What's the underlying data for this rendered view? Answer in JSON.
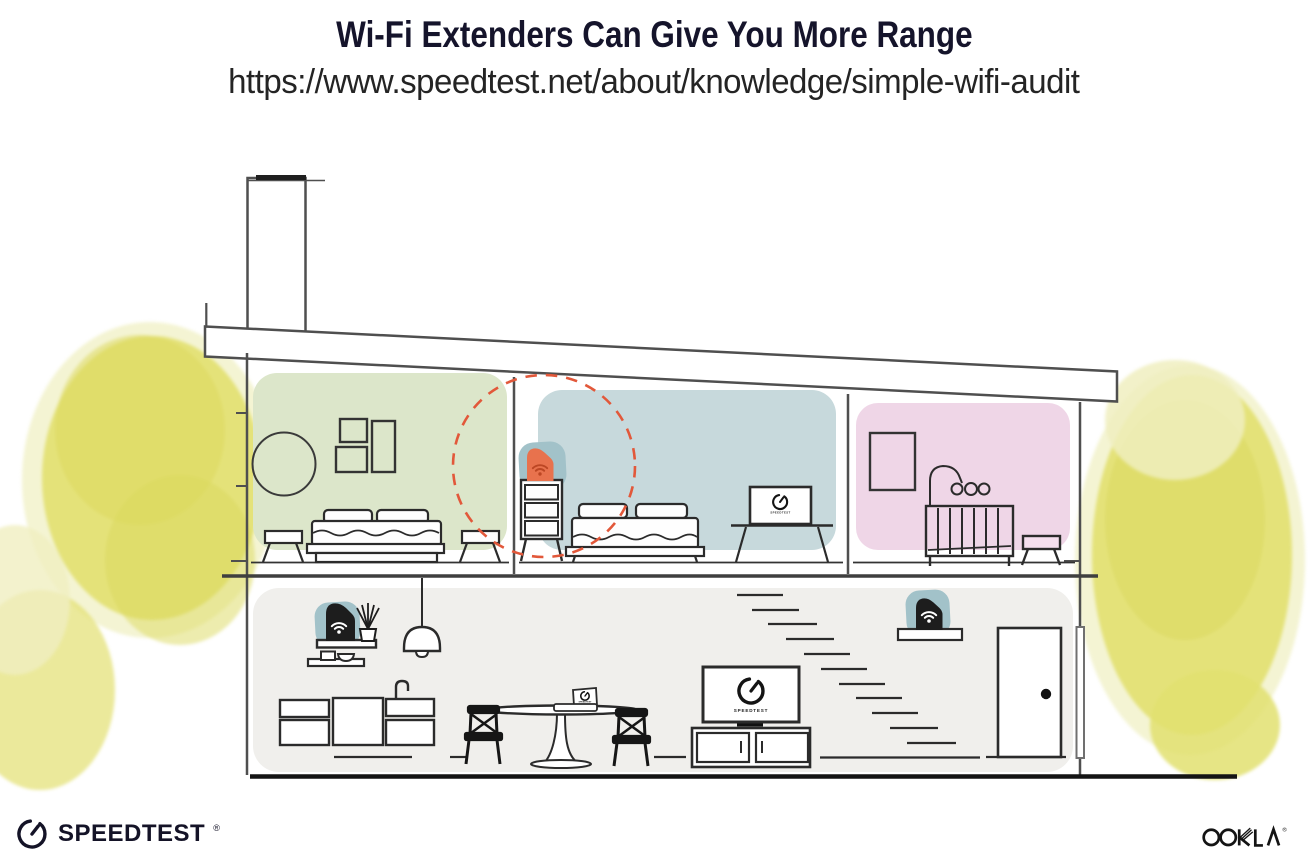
{
  "header": {
    "title": "Wi-Fi Extenders Can Give You More Range",
    "url": "https://www.speedtest.net/about/knowledge/simple-wifi-audit"
  },
  "illustration": {
    "tv_label": "SPEEDTEST",
    "rooms": [
      {
        "name": "bedroom-left",
        "wall_color_key": "green_room"
      },
      {
        "name": "bedroom-middle",
        "wall_color_key": "blue_room"
      },
      {
        "name": "nursery",
        "wall_color_key": "pink_room"
      },
      {
        "name": "living-area",
        "wall_color_key": "floor_gray"
      }
    ],
    "devices": [
      {
        "name": "wifi-router",
        "floor": "first",
        "location": "wall shelf above kitchen",
        "color": "black"
      },
      {
        "name": "wifi-extender-first-floor",
        "floor": "first",
        "location": "shelf by staircase",
        "color": "black"
      },
      {
        "name": "wifi-extender-second-floor",
        "floor": "second",
        "location": "dresser between bedrooms",
        "color": "orange",
        "highlight": "dashed coverage circle"
      }
    ],
    "colors": {
      "green_room": "#dce6ca",
      "blue_room": "#c7d9dc",
      "pink_room": "#efd6e7",
      "floor_gray": "#f0efec",
      "teal_accent": "#a2c2c9",
      "orange_accent": "#e8724d",
      "wifi_orange_dark": "#bc4724",
      "dashed_circle": "#e2583a",
      "foliage_core": "#e2e070",
      "foliage_dark": "#dcd95e",
      "foliage_halo": "#f0efc0",
      "line_gray": "#4f4f4f",
      "furniture_ink": "#2b2b2b",
      "ink": "#141327"
    }
  },
  "footer": {
    "speedtest": "SPEEDTEST",
    "speedtest_mark": "®",
    "ookla": "OOKLA",
    "ookla_mark": "®"
  }
}
